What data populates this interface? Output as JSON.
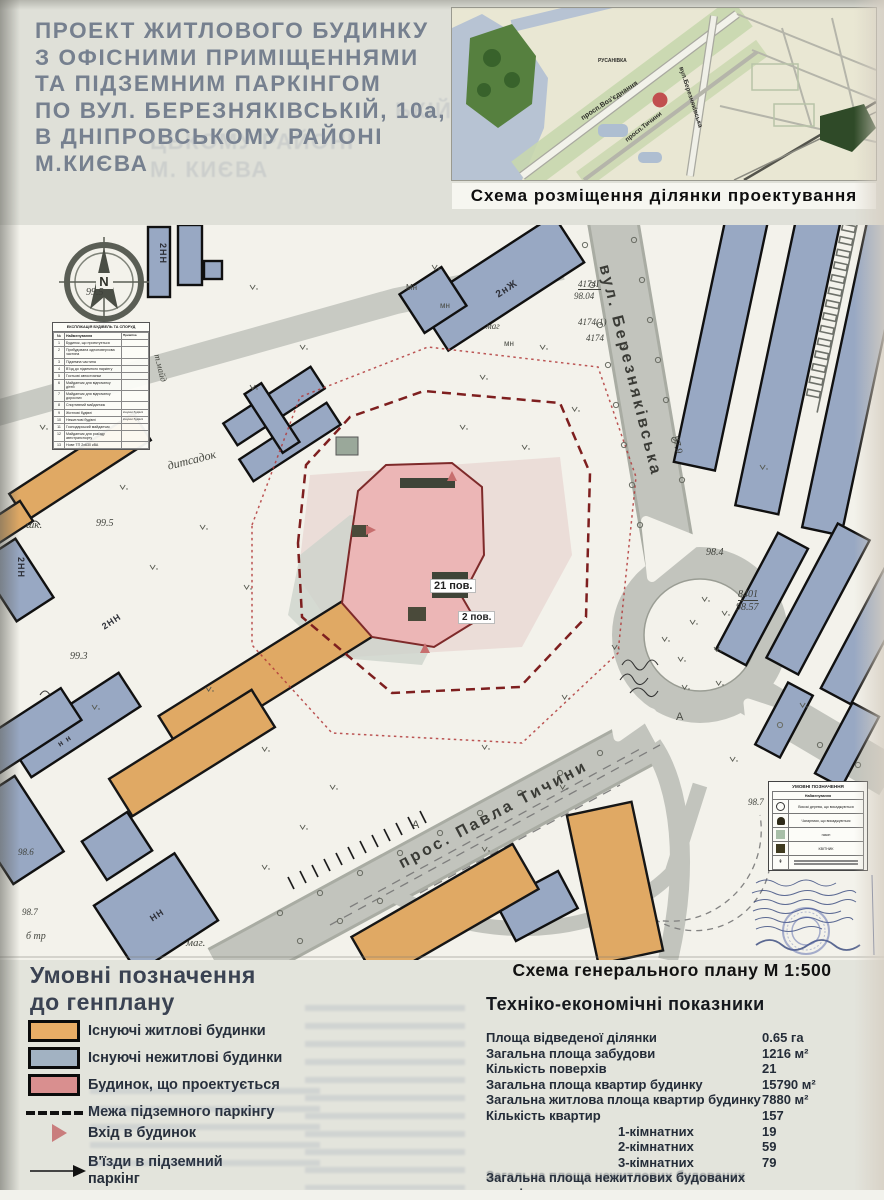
{
  "poster": {
    "title_lines": [
      "ПРОЕКТ ЖИТЛОВОГО БУДИНКУ",
      "З ОФІСНИМИ ПРИМІЩЕННЯМИ",
      "ТА ПІДЗЕМНИМ ПАРКІНГОМ",
      "ПО ВУЛ. БЕРЕЗНЯКІВСЬКІЙ, 10а,",
      "В ДНІПРОВСЬКОМУ РАЙОНІ",
      "М.КИЄВА"
    ],
    "title_ghost_lines": [
      "ЬКІЙ, 10-А",
      "ЦЬКОМУ РАЙОНІ",
      "М. КИЄВА"
    ]
  },
  "minimap": {
    "caption": "Схема розміщення ділянки проектування",
    "labels": [
      {
        "text": "просп.Воз'єднання",
        "x": 128,
        "y": 108,
        "rot": -33,
        "size": 7
      },
      {
        "text": "просп.Тичини",
        "x": 172,
        "y": 130,
        "rot": -38,
        "size": 6.5
      },
      {
        "text": "вул.Березняківська",
        "x": 232,
        "y": 58,
        "rot": 72,
        "size": 6.5
      },
      {
        "text": "РУСАНІВКА",
        "x": 146,
        "y": 50,
        "rot": 0,
        "size": 5
      }
    ]
  },
  "plan": {
    "labels": [
      {
        "text": "вул. Березняківська",
        "x": 612,
        "y": 38,
        "rot": 76,
        "size": 16,
        "cls": "road"
      },
      {
        "text": "прос. Павла Тичини",
        "x": 396,
        "y": 632,
        "rot": -28,
        "size": 16,
        "cls": "road"
      },
      {
        "text": "дитсадок",
        "x": 166,
        "y": 234,
        "rot": -14,
        "size": 12,
        "cls": "serif"
      },
      {
        "text": "шк.",
        "x": 26,
        "y": 294,
        "size": 11,
        "cls": "serif"
      },
      {
        "text": "99.5",
        "x": 96,
        "y": 293,
        "size": 10,
        "cls": "elev"
      },
      {
        "text": "99.5",
        "x": 86,
        "y": 62,
        "size": 10,
        "cls": "elev"
      },
      {
        "text": "99.3",
        "x": 70,
        "y": 426,
        "size": 10,
        "cls": "elev"
      },
      {
        "text": "98.6",
        "x": 18,
        "y": 622,
        "size": 9,
        "cls": "elev"
      },
      {
        "text": "98.7",
        "x": 22,
        "y": 682,
        "size": 9,
        "cls": "elev"
      },
      {
        "text": "б тр",
        "x": 26,
        "y": 706,
        "size": 10,
        "cls": "serif"
      },
      {
        "text": "маг.",
        "x": 186,
        "y": 712,
        "size": 11,
        "cls": "serif"
      },
      {
        "text": "маг",
        "x": 486,
        "y": 96,
        "size": 9,
        "cls": "serif"
      },
      {
        "text": "мн",
        "x": 440,
        "y": 76,
        "size": 8,
        "cls": "tiny"
      },
      {
        "text": "мн",
        "x": 504,
        "y": 114,
        "size": 8,
        "cls": "tiny"
      },
      {
        "text": "Мн",
        "x": 406,
        "y": 58,
        "size": 8,
        "cls": "tiny"
      },
      {
        "text": "2нЖ",
        "x": 494,
        "y": 66,
        "rot": -33,
        "size": 10,
        "cls": "bldg"
      },
      {
        "text": "2НН",
        "x": 168,
        "y": 18,
        "rot": 90,
        "size": 9,
        "cls": "bldg"
      },
      {
        "text": "2НН",
        "x": 26,
        "y": 332,
        "rot": 90,
        "size": 9,
        "cls": "bldg"
      },
      {
        "text": "2НН",
        "x": 100,
        "y": 398,
        "rot": -33,
        "size": 9,
        "cls": "bldg"
      },
      {
        "text": "НН",
        "x": 148,
        "y": 690,
        "rot": -33,
        "size": 9,
        "cls": "bldg"
      },
      {
        "text": "н н",
        "x": 56,
        "y": 516,
        "rot": -33,
        "size": 8,
        "cls": "bldg"
      },
      {
        "text": "97.9",
        "x": 680,
        "y": 210,
        "rot": 76,
        "size": 10,
        "cls": "elev"
      },
      {
        "text": "98.4",
        "x": 706,
        "y": 322,
        "size": 10,
        "cls": "elev"
      },
      {
        "text": "8401",
        "x": 738,
        "y": 364,
        "size": 10,
        "cls": "elev u"
      },
      {
        "text": "98.57",
        "x": 736,
        "y": 377,
        "size": 10,
        "cls": "elev"
      },
      {
        "text": "4174Г",
        "x": 578,
        "y": 54,
        "size": 9,
        "cls": "elev u"
      },
      {
        "text": "98.04",
        "x": 574,
        "y": 66,
        "size": 9,
        "cls": "elev"
      },
      {
        "text": "4174(1)",
        "x": 578,
        "y": 92,
        "size": 9,
        "cls": "elev"
      },
      {
        "text": "4174",
        "x": 586,
        "y": 108,
        "size": 9,
        "cls": "elev"
      },
      {
        "text": "98.7",
        "x": 748,
        "y": 572,
        "size": 9,
        "cls": "elev"
      },
      {
        "text": "А",
        "x": 676,
        "y": 486,
        "size": 11,
        "cls": "tiny"
      },
      {
        "text": "А",
        "x": 412,
        "y": 594,
        "size": 11,
        "cls": "tiny"
      },
      {
        "text": "т.майд",
        "x": 162,
        "y": 128,
        "rot": 76,
        "size": 9,
        "cls": "serif"
      },
      {
        "text": "21 пов.",
        "x": 430,
        "y": 354,
        "size": 11,
        "cls": "boxed"
      },
      {
        "text": "2 пов.",
        "x": 458,
        "y": 386,
        "size": 10,
        "cls": "boxed"
      }
    ],
    "explication": {
      "title": "ЕКСПЛІКАЦІЯ БУДІВЕЛЬ ТА СПОРУД",
      "headers": [
        "№",
        "Найменування",
        "Примітка"
      ],
      "rows": [
        [
          "1",
          "Будинок, що проектується",
          ""
        ],
        [
          "2",
          "Прибудована одноповерхова частина",
          ""
        ],
        [
          "3",
          "Підземна частина",
          ""
        ],
        [
          "4",
          "В'їзд до підземного паркінгу",
          ""
        ],
        [
          "5",
          "Гостьові автостоянки",
          ""
        ],
        [
          "6",
          "Майданчик для відпочинку дітей",
          ""
        ],
        [
          "7",
          "Майданчик для відпочинку дорослих",
          ""
        ],
        [
          "8",
          "Спортивний майданчик",
          ""
        ],
        [
          "9",
          "Житлові будівлі",
          "існуючі будівлі"
        ],
        [
          "10",
          "Нежитлові будівлі",
          "існуючі будівлі"
        ],
        [
          "11",
          "Господарський майданчик",
          ""
        ],
        [
          "12",
          "Майданчик для розїзду автотранспорту",
          ""
        ],
        [
          "13",
          "Нове ТП 2х630 кВА",
          ""
        ]
      ]
    },
    "mini_legend": {
      "title": "УМОВНІ ПОЗНАЧЕННЯ",
      "subtitle": "Найменування",
      "rows": [
        {
          "sym": "tree",
          "label": "Високі дерева, що висаджуються"
        },
        {
          "sym": "shrub",
          "label": "Чагарники, що висаджуються"
        },
        {
          "sym": "lawn",
          "label": "газон"
        },
        {
          "sym": "flower",
          "label": "КВІТНИК"
        },
        {
          "sym": "lines",
          "label": ""
        }
      ]
    }
  },
  "genplan_caption": "Схема генерального плану М 1:500",
  "legend": {
    "heading_lines": [
      "Умовні позначення",
      "до генплану"
    ],
    "items": [
      {
        "type": "swatch-orange",
        "label": "Існуючі житлові будинки"
      },
      {
        "type": "swatch-blue",
        "label": "Існуючі нежитлові будинки"
      },
      {
        "type": "swatch-pink",
        "label": "Будинок, що проектується"
      },
      {
        "type": "dash",
        "label": "Межа підземного паркінгу"
      },
      {
        "type": "triangle",
        "label": "Вхід в будинок"
      },
      {
        "type": "arrow",
        "label": "В'їзди в підземний паркінг"
      },
      {
        "type": "reddash",
        "label": "Межа землевідведення"
      }
    ]
  },
  "tep": {
    "title": "Техніко-економічні показники",
    "rows": [
      {
        "label": "Площа відведеної ділянки",
        "value": "0.65 га",
        "indent": false
      },
      {
        "label": "Загальна площа забудови",
        "value": "1216 м²",
        "indent": false
      },
      {
        "label": "Кількість поверхів",
        "value": "21",
        "indent": false
      },
      {
        "label": "Загальна площа квартир будинку",
        "value": "15790 м²",
        "indent": false
      },
      {
        "label": "Загальна житлова площа квартир будинку",
        "value": "7880 м²",
        "indent": false
      },
      {
        "label": "Кількість квартир",
        "value": "157",
        "indent": false
      },
      {
        "label": "1-кімнатних",
        "value": "19",
        "indent": true
      },
      {
        "label": "2-кімнатних",
        "value": "59",
        "indent": true
      },
      {
        "label": "3-кімнатних",
        "value": "79",
        "indent": true
      },
      {
        "label": "Загальна площа нежитлових будованих",
        "value": "",
        "indent": false
      },
      {
        "label": "приміщень",
        "value": "",
        "indent": false
      }
    ],
    "ghost_label": "Загальна площа нежитлових будованих"
  },
  "colors": {
    "residential_existing": "#e9ad66",
    "nonresidential_existing": "#a2b2c2",
    "projected_building": "#ecb6b6",
    "parking_boundary": "#7e1f1f",
    "land_boundary": "#b23a3a",
    "road": "#c2c4bd",
    "location_dot": "#c14f4f"
  }
}
